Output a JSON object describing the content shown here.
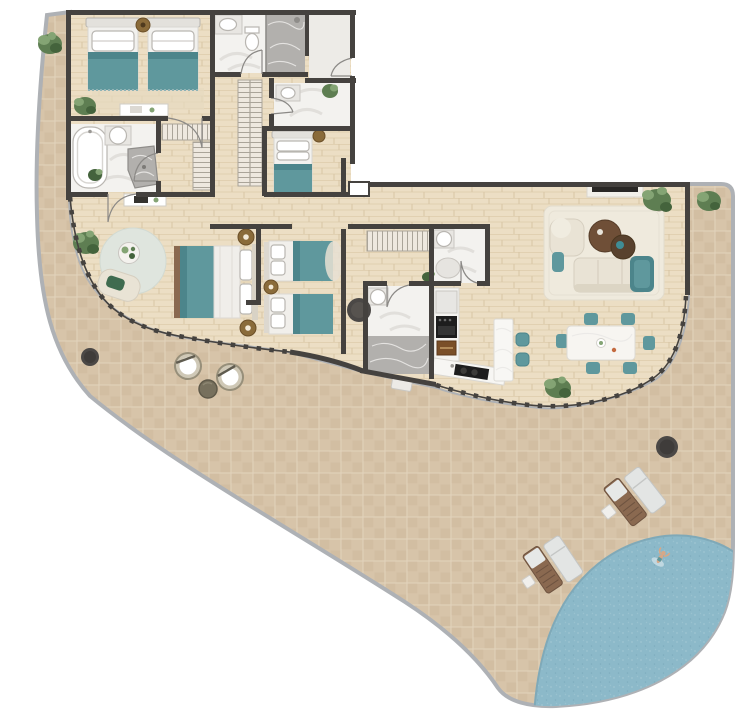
{
  "meta": {
    "kind": "architectural-floor-plan-render",
    "width_px": 747,
    "height_px": 712,
    "visible_text": "none"
  },
  "palette": {
    "background": "#ffffff",
    "terrace-tile": "#d7c4a9",
    "terrace-tile-alt": "#cdb89c",
    "terrace-grout": "#e2d3bc",
    "terrace-edge": "#aeb1b5",
    "wood-floor": "#ecdec4",
    "wood-grain": "#e1d0b1",
    "wood-seam": "#d8c5a5",
    "wall": "#45423f",
    "door-line": "#8b8986",
    "bath-floor": "#f3f2ef",
    "bath-swirl": "#dcdad6",
    "marble": "#b2b0ad",
    "marble-vein": "#e9e8e6",
    "vestibule-floor": "#edebe7",
    "white": "#ffffff",
    "fixture-stroke": "#b9b6b1",
    "teal": "#5f989d",
    "teal-dark": "#4c858b",
    "cream": "#e9e3d5",
    "cream-dark": "#dcd5c4",
    "rug": "#efeadd",
    "rug-edge": "#e2dccd",
    "sitting-rug": "#dfe5de",
    "wood-brown": "#8a6950",
    "wood-brown-dark": "#6e5340",
    "table-brown": "#6f4f37",
    "table-brown-dark": "#58412d",
    "bronze": "#8a6b3a",
    "bronze-dark": "#6b4f28",
    "closet-fill": "#eee8df",
    "closet-line": "#aaa499",
    "pool-fill": "#8cb9c9",
    "pool-light": "#a6cbd6",
    "pool-deep": "#7aa9ba",
    "pool-rim": "#7fa9b8",
    "plant-green": "#5e7e52",
    "plant-light": "#84a474",
    "plant-dark": "#44633c",
    "pot": "#b7b1a7",
    "pot-edge": "#97917f",
    "dark-circle": "#4b4846",
    "tv": "#2a2826",
    "appliance-black": "#1d1d1d",
    "cabinet-wood": "#7a4f28",
    "wicker": "#cfc8b6",
    "wicker-edge": "#978f7a",
    "side-table-olive": "#77705d",
    "skin": "#d7a887"
  },
  "labels": {
    "terrace": "wrap-around terrace",
    "pool": "corner swimming pool",
    "kids_bedroom": "twin kids bedroom",
    "bathroom_1": "bathroom with walk-in shower",
    "entry": "entry vestibule",
    "bathroom_2": "guest bathroom",
    "bathroom_3": "bathroom with freestanding tub",
    "walk_in_closet": "walk-in closet",
    "hall_closet": "hallway wardrobe",
    "single_bedroom": "single bedroom",
    "master_bedroom": "master bedroom with sitting area",
    "twin_bedroom": "second twin bedroom",
    "corridor": "corridor",
    "bathroom_4": "en-suite bathroom",
    "bathroom_5": "bathroom with marble shower",
    "kitchen": "kitchen with island",
    "dining_area": "dining area for six",
    "living_room": "living room",
    "loungers": "sun loungers",
    "terrace_seating": "terrace bistro seating",
    "swimmer": "person swimming"
  },
  "inventory": {
    "bedrooms": 4,
    "bathrooms": 5,
    "beds": 6,
    "dining_chairs": 6,
    "bar_stools": 2,
    "sun_lounger_sets": 2,
    "terrace_chairs": 2,
    "plants": 9,
    "pools": 1
  }
}
